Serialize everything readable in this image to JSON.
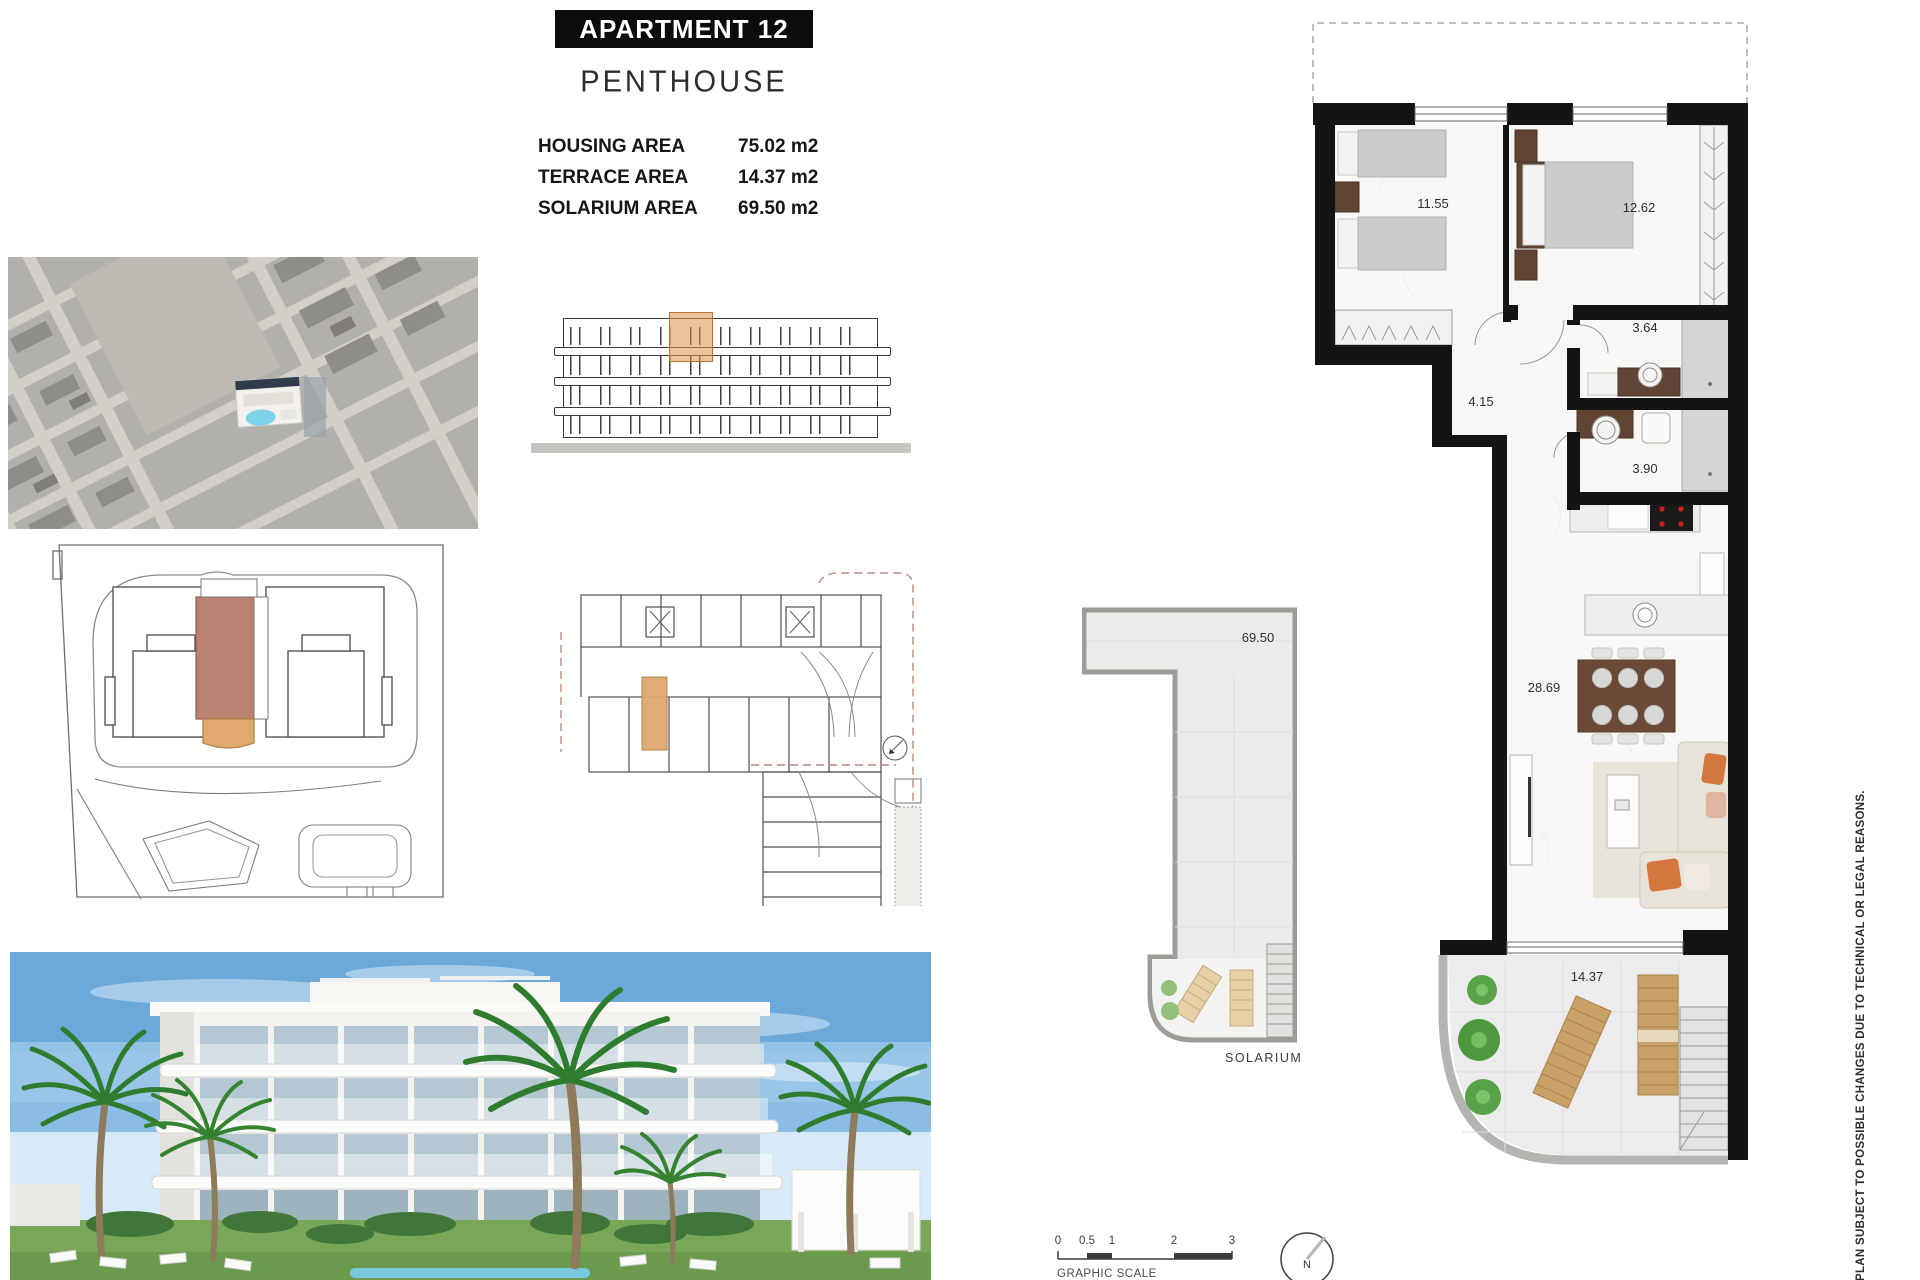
{
  "header": {
    "title": "APARTMENT 12",
    "subtitle": "PENTHOUSE",
    "areas": [
      {
        "label": "HOUSING AREA",
        "value": "75.02 m2"
      },
      {
        "label": "TERRACE AREA",
        "value": "14.37 m2"
      },
      {
        "label": "SOLARIUM AREA",
        "value": "69.50 m2"
      }
    ]
  },
  "floor_plan": {
    "labels": {
      "bedroom2": "11.55",
      "bedroom1": "12.62",
      "bathroom1": "3.64",
      "hall": "4.15",
      "bathroom2": "3.90",
      "living": "28.69",
      "terrace": "14.37"
    }
  },
  "solarium": {
    "area": "69.50",
    "caption": "SOLARIUM"
  },
  "scale": {
    "ticks": [
      "0",
      "0.5",
      "1",
      "2",
      "3"
    ],
    "caption": "GRAPHIC SCALE"
  },
  "compass": {
    "label": "N"
  },
  "disclaimer": "PLAN SUBJECT TO POSSIBLE CHANGES DUE TO TECHNICAL OR LEGAL REASONS.",
  "colors": {
    "wall": "#141414",
    "unit_highlight_site": "#bd8171",
    "unit_highlight_key": "#dfa96f",
    "wood_furniture": "#604534",
    "pool": "#7ed3ea"
  }
}
